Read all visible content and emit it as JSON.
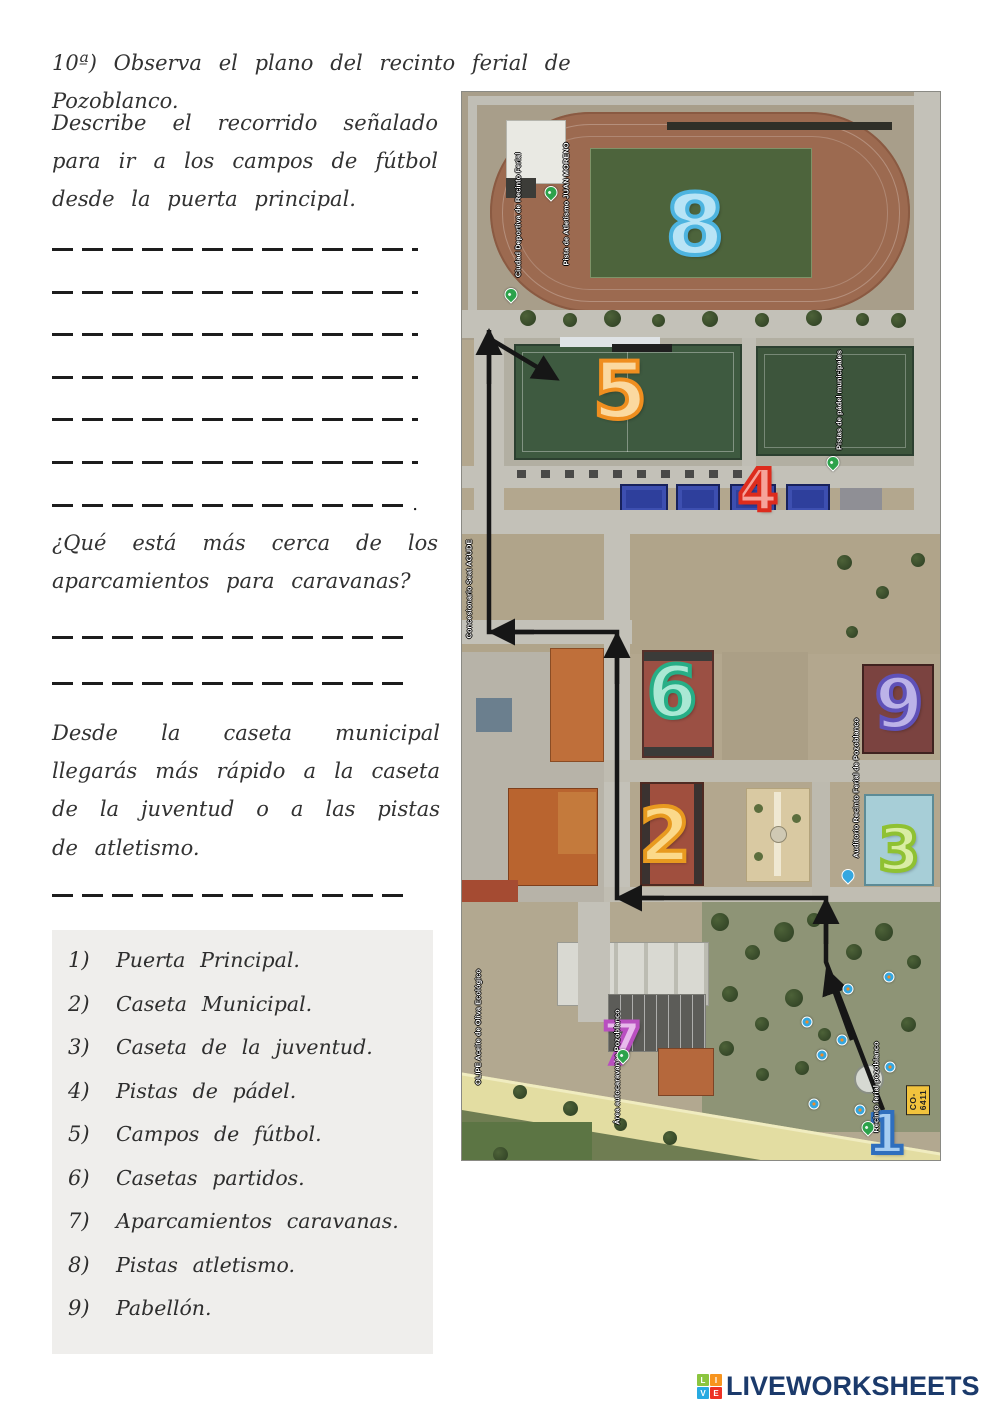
{
  "worksheet": {
    "title": "10ª) Observa el plano del recinto ferial de Pozoblanco.",
    "q1_text": "Describe el recorrido señalado para ir a los campos de fútbol desde la puerta principal.",
    "q1_end_period": ".",
    "q2_text": "¿Qué está más cerca de los aparcamientos para caravanas?",
    "q3_text": "Desde la caseta municipal llegarás más rápido a la caseta de la juventud o a las pistas de atletismo.",
    "legend": [
      {
        "num": "1)",
        "label": "Puerta Principal."
      },
      {
        "num": "2)",
        "label": "Caseta Municipal."
      },
      {
        "num": "3)",
        "label": "Caseta de la juventud."
      },
      {
        "num": "4)",
        "label": "Pistas de pádel."
      },
      {
        "num": "5)",
        "label": "Campos de fútbol."
      },
      {
        "num": "6)",
        "label": "Casetas partidos."
      },
      {
        "num": "7)",
        "label": "Aparcamientos caravanas."
      },
      {
        "num": "8)",
        "label": "Pistas atletismo."
      },
      {
        "num": "9)",
        "label": "Pabellón."
      }
    ]
  },
  "map": {
    "markers": [
      {
        "n": "1",
        "x": 424,
        "y": 1043,
        "size": 56,
        "stroke": "#2f6fbe",
        "fill": "#a6cdf2"
      },
      {
        "n": "2",
        "x": 203,
        "y": 744,
        "size": 74,
        "stroke": "#e89a1f",
        "fill": "#fbd98a"
      },
      {
        "n": "3",
        "x": 437,
        "y": 758,
        "size": 60,
        "stroke": "#8fc132",
        "fill": "#d9eda4"
      },
      {
        "n": "4",
        "x": 296,
        "y": 398,
        "size": 58,
        "stroke": "#dd2c1d",
        "fill": "#f6a39a"
      },
      {
        "n": "5",
        "x": 158,
        "y": 300,
        "size": 78,
        "stroke": "#ef8e1f",
        "fill": "#fbd9a0"
      },
      {
        "n": "6",
        "x": 210,
        "y": 600,
        "size": 72,
        "stroke": "#27ae86",
        "fill": "#aae8d4"
      },
      {
        "n": "7",
        "x": 160,
        "y": 952,
        "size": 58,
        "stroke": "#b94fc0",
        "fill": "#e8baec"
      },
      {
        "n": "8",
        "x": 233,
        "y": 133,
        "size": 84,
        "stroke": "#4db4e0",
        "fill": "#b8e4f6"
      },
      {
        "n": "9",
        "x": 437,
        "y": 612,
        "size": 70,
        "stroke": "#5f51b8",
        "fill": "#bcb3e8"
      }
    ],
    "labels": [
      {
        "text": "Ciudad Deportiva de Recinto Ferial",
        "x": 56,
        "y": 123
      },
      {
        "text": "Pista de Atletismo JUAN MORENO",
        "x": 104,
        "y": 112
      },
      {
        "text": "Pistas de pádel municipales",
        "x": 377,
        "y": 308
      },
      {
        "text": "Concesionario Seat AGUDE",
        "x": 7,
        "y": 497
      },
      {
        "text": "Auditorio Recinto Ferial de Pozoblanco",
        "x": 394,
        "y": 696
      },
      {
        "text": "OLIPE Aceite de Oliva Ecológico",
        "x": 16,
        "y": 935
      },
      {
        "text": "Área autocaravanas Pozoblanco",
        "x": 155,
        "y": 975
      },
      {
        "text": "Recinto ferial pozoblanco",
        "x": 414,
        "y": 995
      }
    ],
    "road_badge": "CO-6411"
  },
  "footer": {
    "brand": "LIVEWORKSHEETS",
    "tiles": [
      {
        "letter": "L",
        "color": "#8bc53f"
      },
      {
        "letter": "I",
        "color": "#f7941e"
      },
      {
        "letter": "V",
        "color": "#27aae1"
      },
      {
        "letter": "E",
        "color": "#ed3124"
      }
    ]
  }
}
